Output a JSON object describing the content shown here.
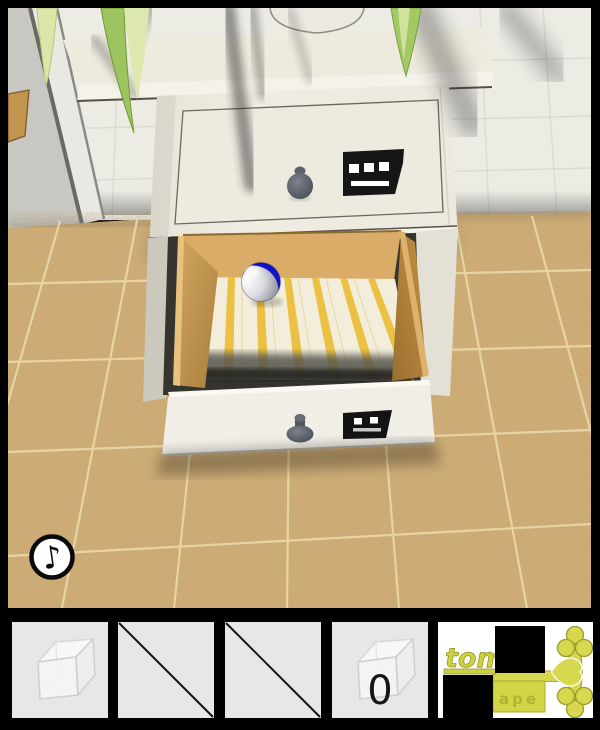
{
  "scene": {
    "music_button": {
      "glyph": "♪",
      "icon": "music-note-icon"
    },
    "cabinet": {
      "top_drawer_sign": {
        "dots": 3
      },
      "bottom_drawer_sign": {
        "dots": 2
      },
      "open_drawer_contents": "blue-white-ball"
    },
    "colors": {
      "floor_tile": "#d0ad76",
      "floor_grout": "#ecdcae",
      "wall": "#ecebe4",
      "cabinet_white": "#efece2",
      "drawer_wood": "#c99d58",
      "lining_stripe": "#ecc143",
      "ball_blue": "#1212c8",
      "key_gold": "#d6d84f",
      "plant_green": "#9dc45e"
    }
  },
  "inventory": {
    "slots": [
      {
        "id": 1,
        "item": "glass-cube",
        "empty": false
      },
      {
        "id": 2,
        "item": null,
        "empty": true
      },
      {
        "id": 3,
        "item": null,
        "empty": true
      },
      {
        "id": 4,
        "item": "glass-cube-zero",
        "label": "0",
        "empty": false
      },
      {
        "id": 5,
        "item": "gold-key",
        "text_top": "tom",
        "text_shaft": "ape",
        "empty": false,
        "selected": true
      }
    ]
  }
}
